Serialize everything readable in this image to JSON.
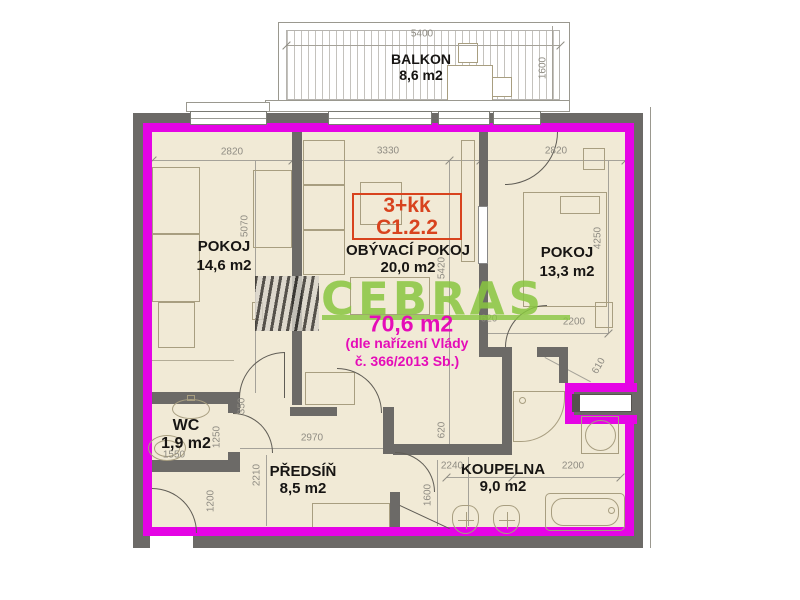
{
  "unit": {
    "layout": "3+kk",
    "code": "C1.2.2"
  },
  "watermark": {
    "brand": "CEBRAS",
    "total_area": "70,6 m2",
    "note_line1": "(dle nařízení Vlády",
    "note_line2": "č. 366/2013 Sb.)"
  },
  "rooms": {
    "balkon": {
      "name": "BALKON",
      "area": "8,6 m2"
    },
    "pokoj_left": {
      "name": "POKOJ",
      "area": "14,6 m2"
    },
    "obyvaci_pokoj": {
      "name": "OBÝVACÍ POKOJ",
      "area": "20,0 m2"
    },
    "pokoj_right": {
      "name": "POKOJ",
      "area": "13,3 m2"
    },
    "wc": {
      "name": "WC",
      "area": "1,9 m2"
    },
    "predsin": {
      "name": "PŘEDSÍŇ",
      "area": "8,5 m2"
    },
    "koupelna": {
      "name": "KOUPELNA",
      "area": "9,0 m2"
    }
  },
  "dimensions": {
    "balkon_width": "5400",
    "balkon_depth": "1600",
    "pokoj_left_width": "2820",
    "obyvaci_width": "3330",
    "pokoj_right_width": "2820",
    "pokoj_left_height": "5070",
    "obyvaci_height": "5420",
    "pokoj_right_height": "4250",
    "pokoj_right_door": "620",
    "pokoj_right_bottom": "2200",
    "entry_niche": "610",
    "wc_height": "1250",
    "wc_width": "1550",
    "hall_door_left": "1200",
    "wc_door": "350",
    "predsin_width": "2970",
    "predsin_height": "2210",
    "koupelna_door": "620",
    "koupelna_left_width": "2240",
    "koupelna_right_width": "2200",
    "koupelna_height": "1600"
  },
  "colors": {
    "highlight_outline": "#e504e5",
    "unit_label_red": "#d8431e",
    "brand_green": "#8dc63f",
    "overlay_magenta": "#e50cb8",
    "wall_gray": "#6c6a67",
    "floor_beige": "#f1ead6"
  }
}
